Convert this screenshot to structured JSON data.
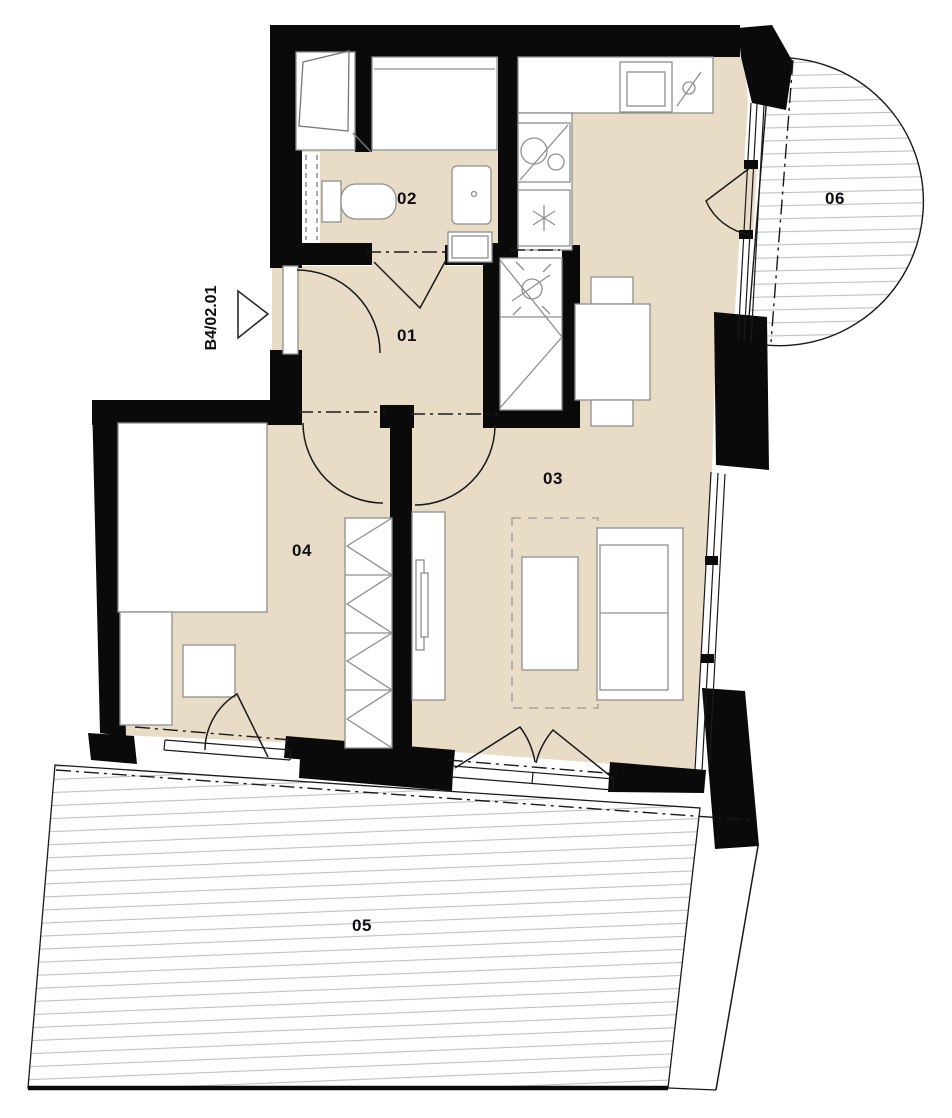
{
  "plan": {
    "unit_label": "B4/02.01",
    "room_labels": {
      "r01": "01",
      "r02": "02",
      "r03": "03",
      "r04": "04",
      "r05": "05",
      "r06": "06"
    },
    "colors": {
      "background": "#ffffff",
      "floor": "#e8dcc6",
      "wall": "#0a0a0a",
      "hatch": "#c0c0c0",
      "line": "#1a1a1a",
      "furniture_stroke": "#8f8f8f",
      "label_text": "#0d0d14"
    }
  }
}
